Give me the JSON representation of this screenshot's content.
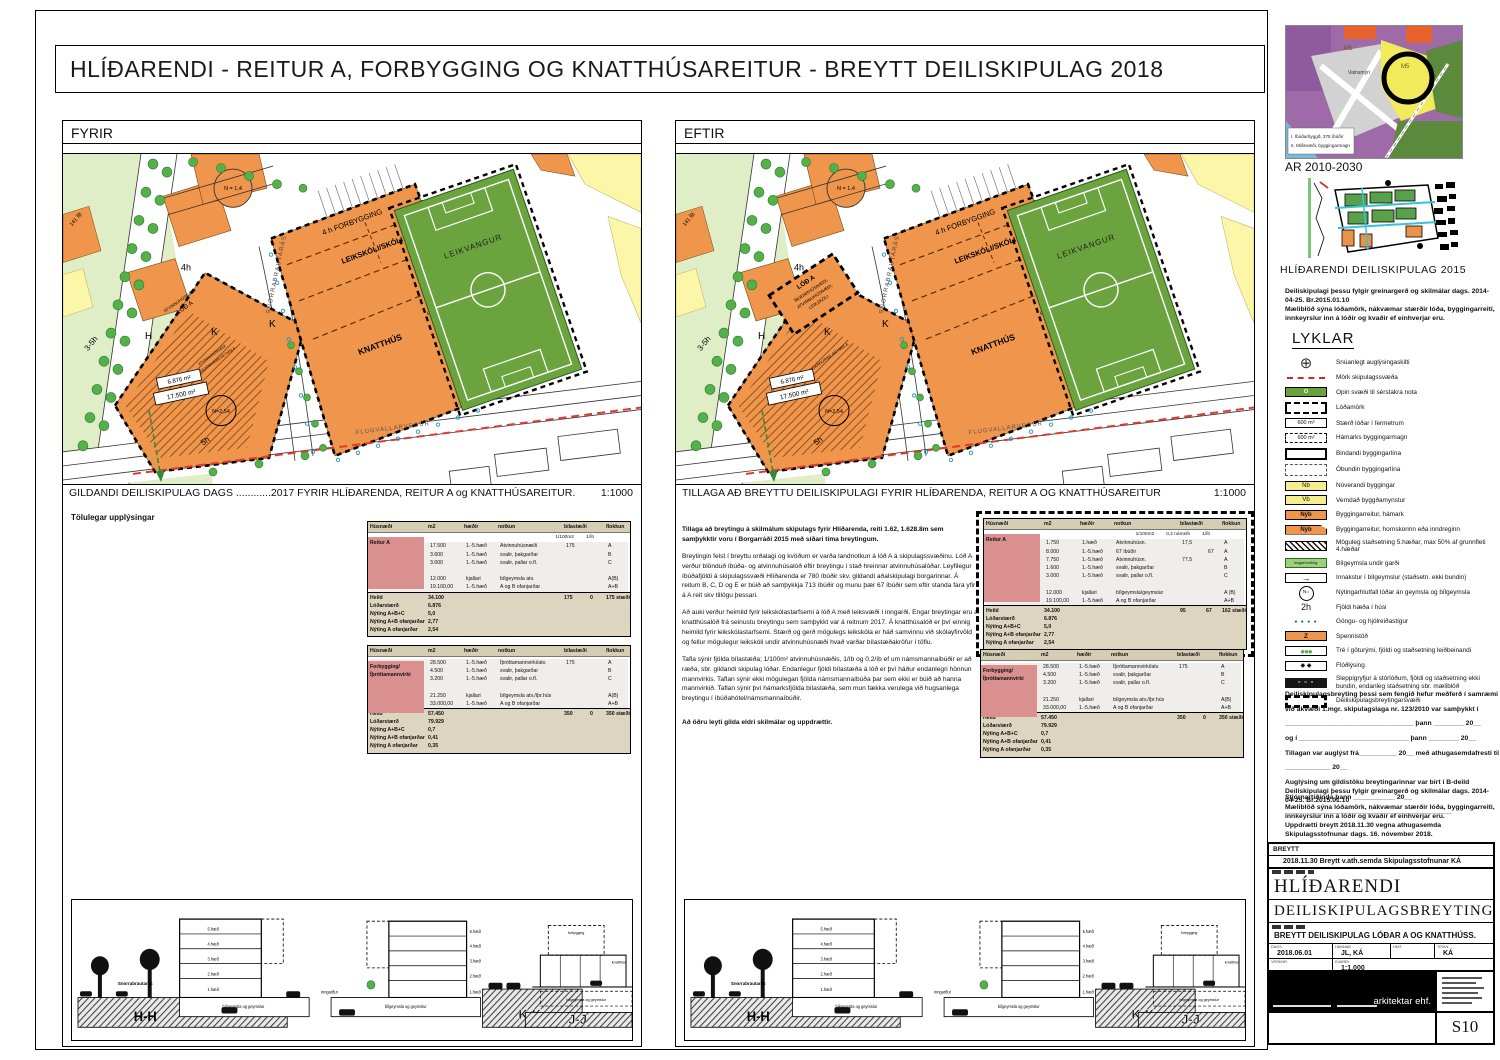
{
  "title": "HLÍÐARENDI -  REITUR A, FORBYGGING OG KNATTHÚSAREITUR - BREYTT DEILISKIPULAG 2018",
  "panels": {
    "fyrir": {
      "label": "FYRIR",
      "caption": "GILDANDI DEILISKIPULAG DAGS ............2017  FYRIR HLÍÐARENDA, REITUR A og KNATTHÚSAREITUR.",
      "scale": "1:1000",
      "tables_heading": "Tölulegar upplýsingar"
    },
    "eftir": {
      "label": "EFTIR",
      "caption": "TILLAGA AÐ BREYTTU DEILISKIPULAGI FYRIR HLÍÐARENDA, REITUR A OG KNATTHÚSAREITUR",
      "scale": "1:1000",
      "para_bold1": "Tillaga að breytingu á skilmálum skipulags fyrir Hlíðarenda,  reiti 1.62, 1.628.8m sem samþykktir voru í Borgarráði 2015 með síðari tíma breytingum.",
      "para2": "Breytingin felst í breyttu orðalagi og kvöðum er varða landnotkun á lóð A á skipulagssvæðinu. Lóð A verður blönduð íbúða- og atvinnuhúsalóð eftir breytingu í stað hreinnar atvinnuhúsalóðar. Leyfilegur íbúðafjöldi á skipulagssvæði Hlíðarenda er 780 íbúðir skv. gildandi aðalskipulagi borgarinnar. Á reitum B, C, D og E er búið að samþykkja 713 íbúðir og munu þær 67 íbúðir sem eftir standa fara yfir á A reit skv tillögu þessari.",
      "para3": "Að auki verður heimild fyrir leikskólastarfsemi á lóð A með leiksvæði í inngarði. Engar breytingar eru á knatthúsalóð frá seinustu breytingu sem samþykkt var á reitnum 2017. Á knatthúsalóð er því einnig heimild fyrir leikskólastarfsemi. Stærð og gerð mögulegs leikskóla er háð samvinnu við skólayfirvöld og fellur mögulegur leikskóli undir atvinnuhúsnæði hvað varðar bílastæðakröfur í töflu.",
      "para4": "Tafla sýnir fjölda bílastæða;  1/100m² atvinnuhúsnæðis, 1/íb og 0.2/íb ef um námsmannaíbúðir er að ræða, sbr. gildandi skipulag lóðar. Endanlegur fjöldi bílastæða á lóð er því háður endanlegri hönnun mannvirkis. Taflan sýnir ekki mögulegan fjölda námsmannaíbúða þar sem ekki er búið að hanna mannvirkið. Taflan sýnir því hámarksfjölda bílastæða, sem mun fækka verulega við hugsanlega breytingu í íbúðahótel/námsmannaíbúðir.",
      "para_bold5": "Að öðru leyti gilda eldri skilmálar og uppdrættir."
    }
  },
  "maps": {
    "labels": {
      "forbygging": "4 h FORBYGGING",
      "leikskoli": "LEIKSKÓLI/SKÓLI",
      "knatthus": "KNATTHÚS",
      "stuka": "STÚKA",
      "leikvangur": "LEIKVANGUR",
      "flugvallarvegur": "FLUGVALLARVEGUR",
      "snorrabraut": "SNORRABRAUTARÁS",
      "atvinnu": "ATVINNUHÚSNÆÐI",
      "lod_a": "LÓÐ A",
      "inngardur": "INNGARÐUR/BÍLGEYMSLA",
      "area1": "6.876 m²",
      "area2": "17.500 m²",
      "n254": "N=2,54",
      "n14": "N = 1,4",
      "h4": "4h",
      "h5": "5h",
      "h35": "3-5h",
      "ib141": "141 ÍB",
      "mh": "H",
      "mk": "K"
    },
    "eftir_box": {
      "l1": "LÓÐ A",
      "l2": "ÍBÚÐARHÚSNÆÐI,",
      "l3": "ATVINNUHÚSNÆÐI,",
      "l4": "LEIKSKÓLI"
    }
  },
  "tables": {
    "headers": [
      "Húsnæði",
      "m2",
      "hæðir",
      "notkun",
      "bílastæði",
      "",
      "flokkun"
    ],
    "fyrir1": {
      "name": "Reitur A",
      "subs": [
        "1/100m2",
        "1/íb"
      ],
      "rows": [
        [
          "",
          "17.500",
          "1.-5.hæð",
          "Atvinnuhúsnæði",
          "175",
          "",
          "A"
        ],
        [
          "",
          "3.600",
          "1.-5.hæð",
          "svalir, þakgarðar",
          "",
          "",
          "B"
        ],
        [
          "",
          "3.000",
          "1.-5.hæð",
          "svalir, pallar o.fl.",
          "",
          "",
          "C"
        ],
        [
          "",
          "",
          "",
          "",
          "",
          "",
          ""
        ],
        [
          "",
          "12.000",
          "kjallari",
          "bílgeymsla atv.",
          "",
          "",
          "A(B)"
        ],
        [
          "",
          "19.100,00",
          "1.-5.hæð",
          "A og B ofanjarðar",
          "",
          "",
          "A+B"
        ]
      ],
      "summary": [
        [
          "Heild",
          "34.100",
          "",
          "",
          "175",
          "0",
          "175 stæði"
        ],
        [
          "Lóðarstærð",
          "6.876",
          "",
          "",
          "",
          "",
          ""
        ],
        [
          "Nýting A+B+C",
          "5,0",
          "",
          "",
          "",
          "",
          ""
        ],
        [
          "Nýting A+B ofanjarðar",
          "2,77",
          "",
          "",
          "",
          "",
          ""
        ],
        [
          "Nýting A ofanjarðar",
          "2,54",
          "",
          "",
          "",
          "",
          ""
        ]
      ]
    },
    "fyrir2": {
      "name": "Forbygging/\nÍþróttamannvirki",
      "subs": [],
      "rows": [
        [
          "",
          "28.500",
          "1.-5.hæð",
          "Íþróttamannvirki/atv.",
          "175",
          "",
          "A"
        ],
        [
          "",
          "4.500",
          "1.-5.hæð",
          "svalir, þakgarðar",
          "",
          "",
          "B"
        ],
        [
          "",
          "3.200",
          "1.-5.hæð",
          "svalir, pallar o.fl.",
          "",
          "",
          "C"
        ],
        [
          "",
          "",
          "",
          "",
          "",
          "",
          ""
        ],
        [
          "",
          "21.250",
          "kjallari",
          "bílgeymsla atv./íþr.hús",
          "",
          "",
          "A(B)"
        ],
        [
          "",
          "33.000,00",
          "1.-5.hæð",
          "A og B ofanjarðar",
          "",
          "",
          "A+B"
        ]
      ],
      "summary": [
        [
          "Heild",
          "57.450",
          "",
          "",
          "350",
          "0",
          "350 stæði"
        ],
        [
          "Lóðarstærð",
          "79.929",
          "",
          "",
          "",
          "",
          ""
        ],
        [
          "Nýting A+B+C",
          "0,7",
          "",
          "",
          "",
          "",
          ""
        ],
        [
          "Nýting A+B ofanjarðar",
          "0,41",
          "",
          "",
          "",
          "",
          ""
        ],
        [
          "Nýting A ofanjarðar",
          "0,35",
          "",
          "",
          "",
          "",
          ""
        ]
      ]
    },
    "eftir1": {
      "name": "Reitur A",
      "subs": [
        "1/100m2",
        "0,2 námsíb",
        "1/íb"
      ],
      "rows": [
        [
          "",
          "1.750",
          "1.hæð",
          "Atvinnuhúsn.",
          "17,5",
          "",
          "A"
        ],
        [
          "",
          "8.000",
          "1.-5.hæð",
          "67 íbúðir",
          "",
          "67",
          "A"
        ],
        [
          "",
          "7.750",
          "1.-5.hæð",
          "Atvinnuhúsn.",
          "77,5",
          "",
          "A"
        ],
        [
          "",
          "1.600",
          "1.-5.hæð",
          "svalir, þakgarðar",
          "",
          "",
          "B"
        ],
        [
          "",
          "3.000",
          "1.-5.hæð",
          "svalir, pallar o.fl.",
          "",
          "",
          "C"
        ],
        [
          "",
          "",
          "",
          "",
          "",
          "",
          ""
        ],
        [
          "",
          "12.000",
          "kjallari",
          "bílgeymsla/geymslur",
          "",
          "",
          "A (B)"
        ],
        [
          "",
          "19.100,00",
          "1.-5.hæð",
          "A og B ofanjarðar",
          "",
          "",
          "A+B"
        ]
      ],
      "summary": [
        [
          "Heild",
          "34.100",
          "",
          "",
          "95",
          "67",
          "162 stæði"
        ],
        [
          "Lóðarstærð",
          "6.876",
          "",
          "",
          "",
          "",
          ""
        ],
        [
          "Nýting A+B+C",
          "5,0",
          "",
          "",
          "",
          "",
          ""
        ],
        [
          "Nýting A+B ofanjarðar",
          "2,77",
          "",
          "",
          "",
          "",
          ""
        ],
        [
          "Nýting A ofanjarðar",
          "2,54",
          "",
          "",
          "",
          "",
          ""
        ]
      ]
    },
    "eftir2": {
      "name": "Forbygging/\nÍþróttamannvirki",
      "subs": [],
      "rows": [
        [
          "",
          "28.500",
          "1.-5.hæð",
          "Íþróttamannvirki/atv.",
          "175",
          "",
          "A"
        ],
        [
          "",
          "4.500",
          "1.-5.hæð",
          "svalir, þakgarðar",
          "",
          "",
          "B"
        ],
        [
          "",
          "3.200",
          "1.-5.hæð",
          "svalir, pallar o.fl.",
          "",
          "",
          "C"
        ],
        [
          "",
          "",
          "",
          "",
          "",
          "",
          ""
        ],
        [
          "",
          "21.250",
          "kjallari",
          "bílgeymsla atv./íþr.hús",
          "",
          "",
          "A(B)"
        ],
        [
          "",
          "33.000,00",
          "1.-5.hæð",
          "A og B ofanjarðar",
          "",
          "",
          "A+B"
        ]
      ],
      "summary": [
        [
          "Heild",
          "57.450",
          "",
          "",
          "350",
          "0",
          "350 stæði"
        ],
        [
          "Lóðarstærð",
          "79.929",
          "",
          "",
          "",
          "",
          ""
        ],
        [
          "Nýting A+B+C",
          "0,7",
          "",
          "",
          "",
          "",
          ""
        ],
        [
          "Nýting A+B ofanjarðar",
          "0,41",
          "",
          "",
          "",
          "",
          ""
        ],
        [
          "Nýting A ofanjarðar",
          "0,35",
          "",
          "",
          "",
          "",
          ""
        ]
      ]
    }
  },
  "sections": {
    "s1": "H-H",
    "s2": "K-K",
    "s3": "J-J",
    "floors": [
      "5.hæð",
      "4.hæð",
      "3.hæð",
      "2.hæð",
      "1.hæð"
    ],
    "basement": "bílgeymsla og geymslur",
    "street": "Snorrabrautarás",
    "inngardur": "inngarður",
    "knatthus": "knatthús",
    "forbygging": "forbygging"
  },
  "sidebar": {
    "ar": {
      "caption": "AR 2010-2030",
      "m5a": "M5",
      "m5b": "M5",
      "vatnsmyri": "Vatnsmýri",
      "leg1": "I.  Íbúðarbyggð, 375 íbúðir",
      "leg2": "II. Miðsvæði, byggingarmagn"
    },
    "plan2015_caption": "HLÍÐARENDI  DEILISKIPULAG  2015",
    "note_skilmalar": "Deiliskipulagi þessu  fylgir  greinargerð og skilmálar dags. 2014-04-25.  Br.2015.01.10",
    "note_maeliblod": "Mæliblöð sýna lóðamörk, nákvæmar stærðir lóða, byggingarreiti, innkeyrslur inn á lóðir og kvaðir ef einhverjar eru.",
    "lyklar": "LYKLAR",
    "legend": [
      {
        "t": "compass",
        "label": "Snúanlegt auglýsingaskilti"
      },
      {
        "t": "redline",
        "label": "Mörk skipulagssvæða"
      },
      {
        "t": "greenO",
        "text": "O",
        "label": "Opin svæði til sérstakra nota"
      },
      {
        "t": "lodamork",
        "label": "Lóðamörk"
      },
      {
        "t": "sizebox",
        "text": "600 m²",
        "label": "Stærð lóðar í fermetrum"
      },
      {
        "t": "maxbox",
        "text": "600 m²",
        "label": "Hámarks byggingarmagn"
      },
      {
        "t": "bindandi",
        "label": "Bindandi byggingarlína"
      },
      {
        "t": "obundin",
        "label": "Óbundin byggingarlína"
      },
      {
        "t": "nb",
        "text": "Nb",
        "label": "Núverandi byggingar"
      },
      {
        "t": "vb",
        "text": "Vb",
        "label": "Verndað byggðamynstur"
      },
      {
        "t": "nyb",
        "text": "Nýb",
        "label": "Byggingarreitur, hámark"
      },
      {
        "t": "nyb2",
        "text": "Nýb",
        "label": "Byggingarreitur, hornskorinn eða inndreginn"
      },
      {
        "t": "hatch",
        "label": "Möguleg staðsetning 5.hæðar, max 50% af grunnfleti 4.hæðar"
      },
      {
        "t": "gardur",
        "text": "Inngarður/bílg.",
        "label": "Bílgeymsla undir garði"
      },
      {
        "t": "arrow",
        "label": "Innakstur í bílgeymslur (staðsetn. ekki bundin)"
      },
      {
        "t": "ncircle",
        "text": "N=",
        "label": "Nýtingarhlutfall lóðar án geymsla og bílgeymsla"
      },
      {
        "t": "txt2h",
        "text": "2h",
        "label": "Fjöldi hæða í húsi"
      },
      {
        "t": "dots",
        "label": "Göngu- og hjólreiðastígur"
      },
      {
        "t": "spenni",
        "text": "Z",
        "label": "Spennistöð"
      },
      {
        "t": "tre",
        "label": "Tré í göturými, fjöldi og staðsetning leiðbeinandi"
      },
      {
        "t": "flood",
        "label": "Flóðlýsing"
      },
      {
        "t": "sleppi",
        "label": "Sleppigryfjur á stórlóðum, fjöldi og staðsetning ekki bundin, endanleg staðsetning sbr. mæliblöð"
      },
      {
        "t": "breytsv",
        "label": "Deiliskipulagsbreytingarsvæði"
      }
    ],
    "approval": [
      "Deiliskipulagsbreyting  þessi sem fengið hefur meðferð í samræmi",
      "við ákvæði  1.mgr. skipulagslaga nr. 123/2010 var samþykkt í",
      "__________________________________ þann ________ 20__",
      "og í _____________________________ þann ________ 20__",
      "Tillagan  var auglýst frá__________ 20__  með athugasemdafresti til",
      "____________ 20__",
      "Auglýsing um gildistöku breytingarinnar var birt í B-deild",
      "Stjórnartíðinda þann ___________ 20__",
      "____________________________________________"
    ],
    "uppdraettir": "Uppdrætti breytt 2018.11.30 vegna athugasemda Skipulagsstofnunar dags. 16. nóvember 2018.",
    "titleblock": {
      "breytt": "BREYTT",
      "revision": "2018.11.30 Breytt  v.ath.semda  Skipulagsstofnunar KÁ",
      "project": "HLÍÐARENDI",
      "type": "DEILISKIPULAGSBREYTING",
      "sheet_title": "BREYTT  DEILISKIPULAG  LÓÐAR  A  OG  KNATTHÚSS.",
      "dags_label": "DAGS.",
      "dags": "2018.06.01",
      "hannad_label": "HANNAÐ",
      "hannad": "JL, KÁ",
      "hnit_label": "HNIT.",
      "hnit": "",
      "teikn_label": "TEIKN.",
      "teikn": "KÁ",
      "verknr_label": "VERKNR.",
      "kvardi_label": "KVARÐI",
      "kvardi": "1:1.000",
      "firm": "arkitektar ehf.",
      "sheet_no": "S10"
    }
  }
}
